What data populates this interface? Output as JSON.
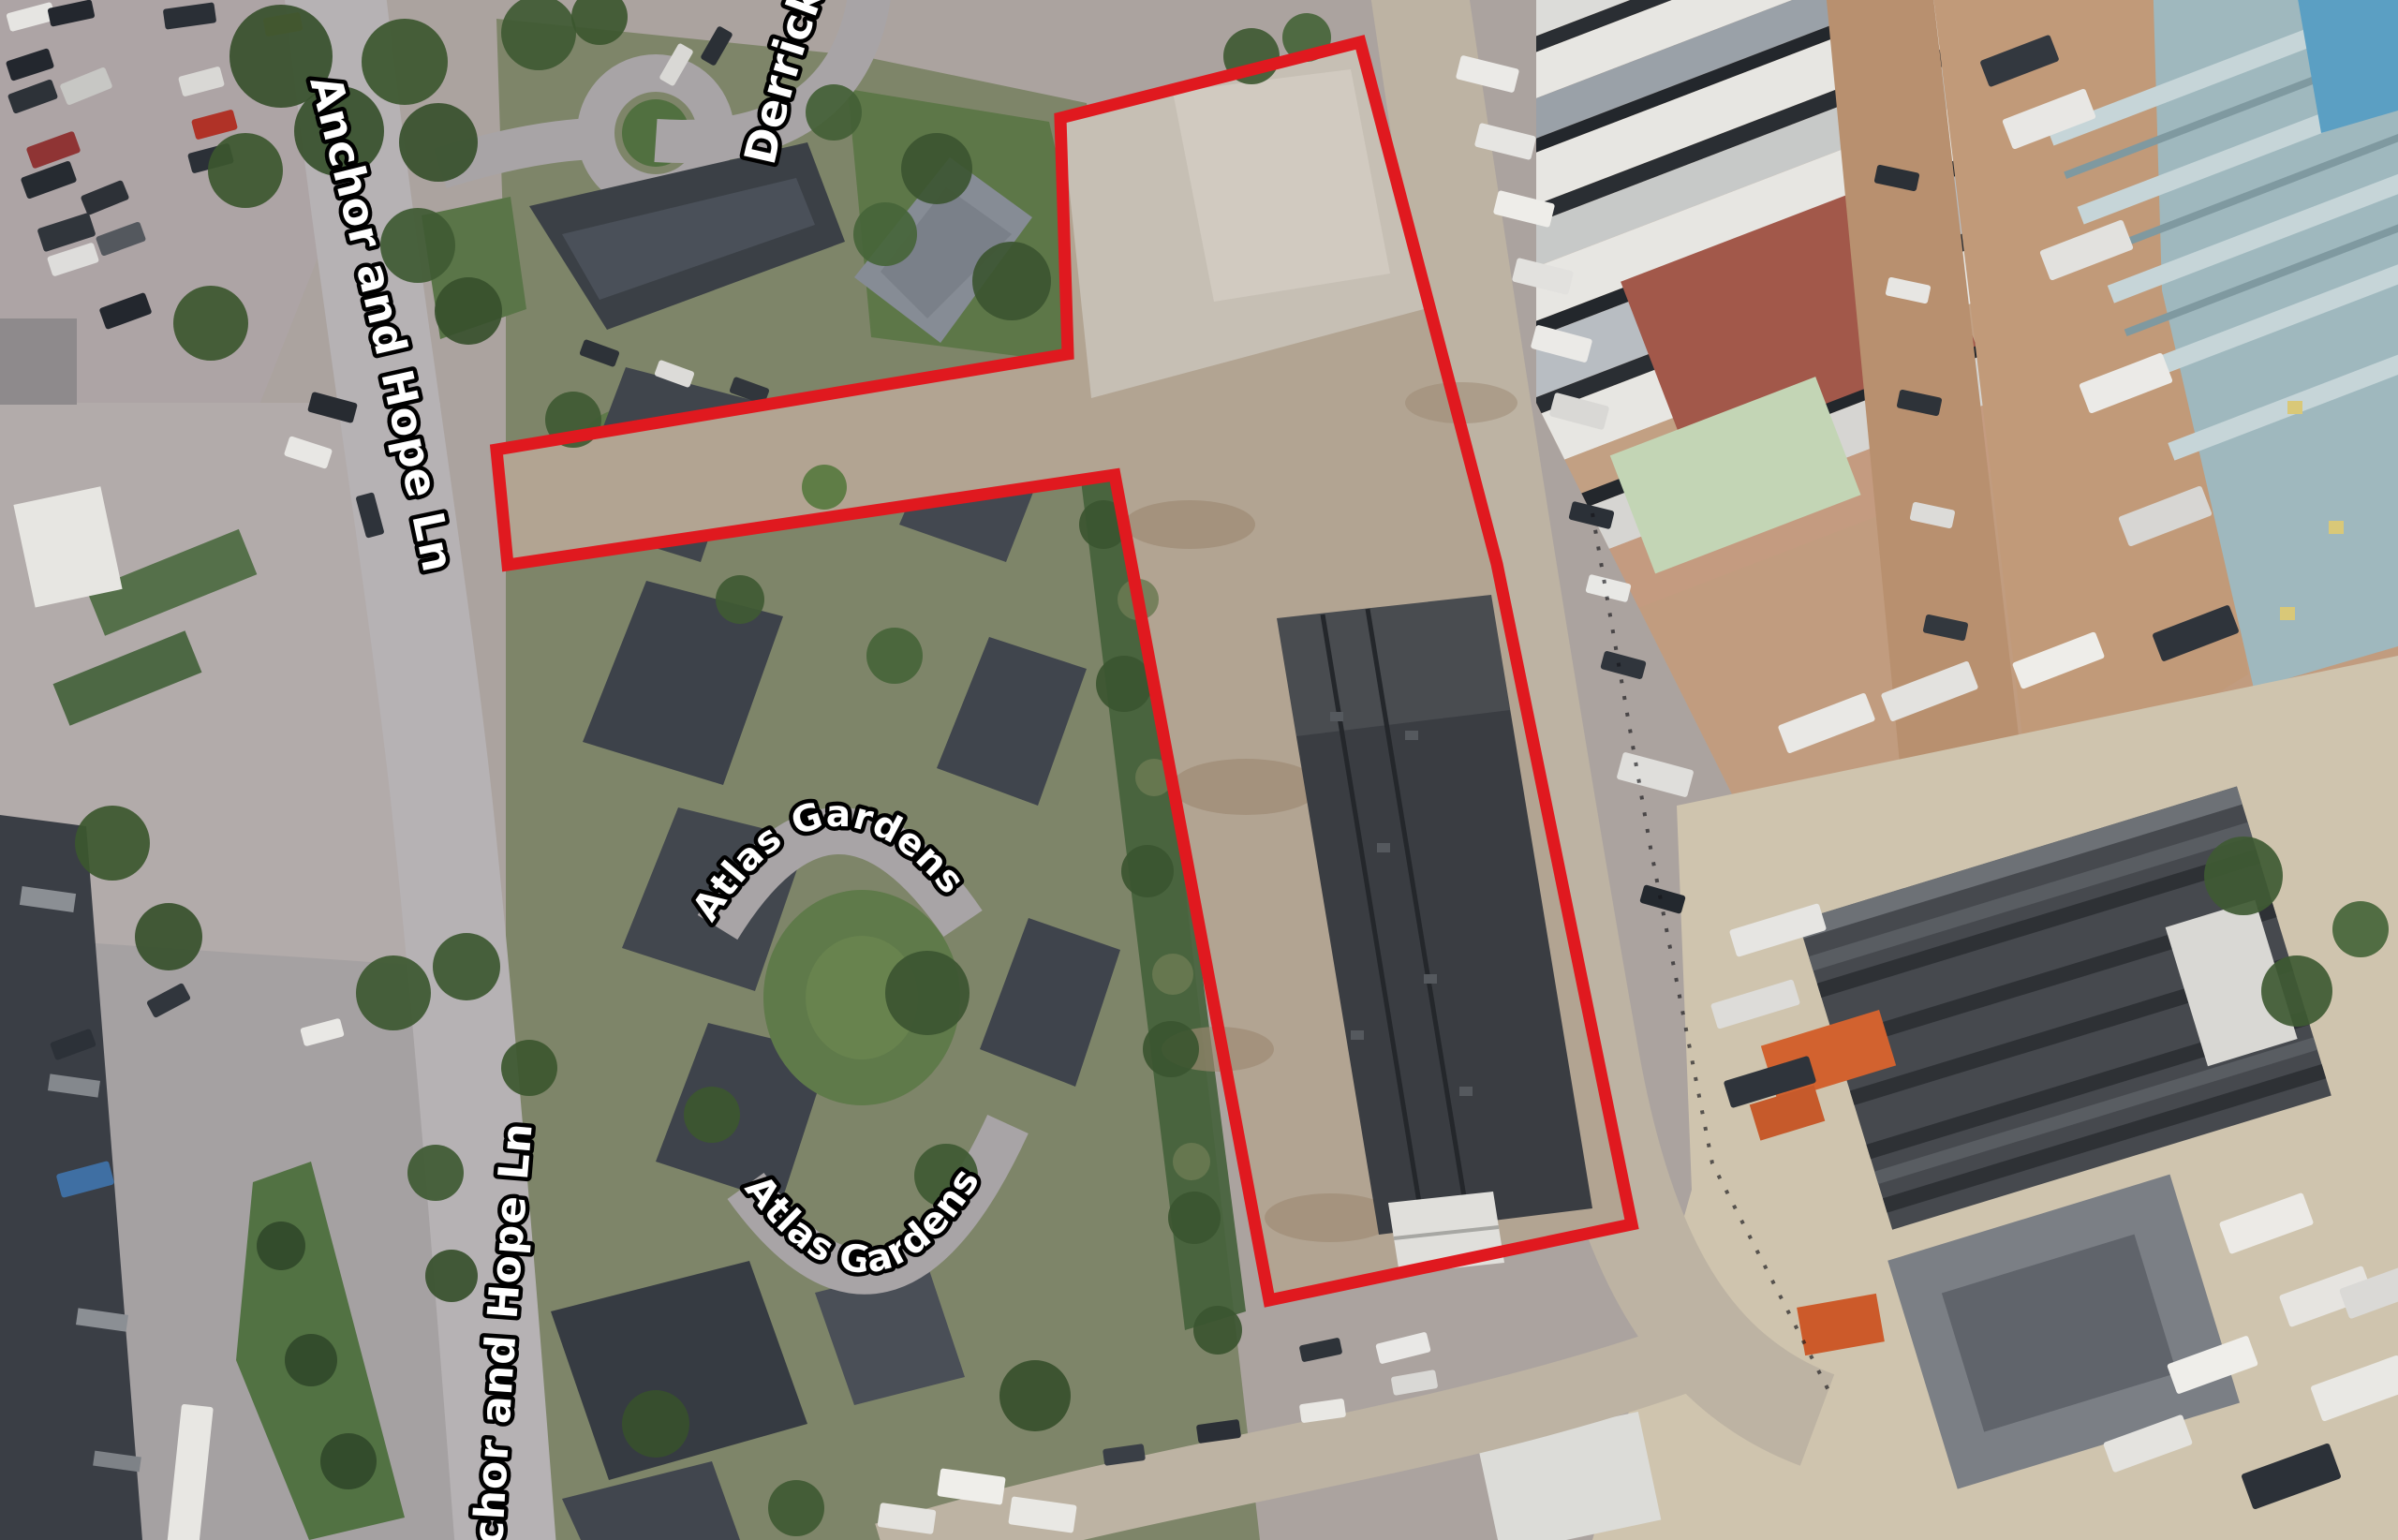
{
  "map": {
    "view": "aerial-satellite-imagery",
    "street_labels": {
      "anchor_and_hope_ln_upper": "Anchor and Hope Ln",
      "derrick": "Derrick",
      "atlas_gardens_upper": "Atlas Gardens",
      "atlas_gardens_lower": "Atlas Gardens",
      "anchor_and_hope_ln_lower": "chor and Hope Ln"
    },
    "annotation": {
      "label": "site-boundary",
      "color": "#e0191f",
      "stroke_width_px": 13,
      "points": [
        [
          1132,
          126
        ],
        [
          1452,
          45
        ],
        [
          1598,
          602
        ],
        [
          1742,
          1307
        ],
        [
          1355,
          1388
        ],
        [
          1190,
          507
        ],
        [
          542,
          603
        ],
        [
          530,
          480
        ],
        [
          1140,
          378
        ]
      ]
    },
    "palette": {
      "label_fill": "#ffffff",
      "label_outline": "#000000",
      "boundary_red": "#e0191f",
      "road_grey": "#b6b2b4",
      "grass_green": "#5f7a4a",
      "dirt_tan": "#b2a492",
      "dark_roof": "#3a3d42",
      "industrial_roof_white": "#e7e6e2",
      "teal_roof": "#9fb8be",
      "blue_roof": "#5b9fc3",
      "container_orange": "#d2622f",
      "red_brown_roof": "#a2584a",
      "pale_green_roof": "#c3d5b5"
    }
  }
}
